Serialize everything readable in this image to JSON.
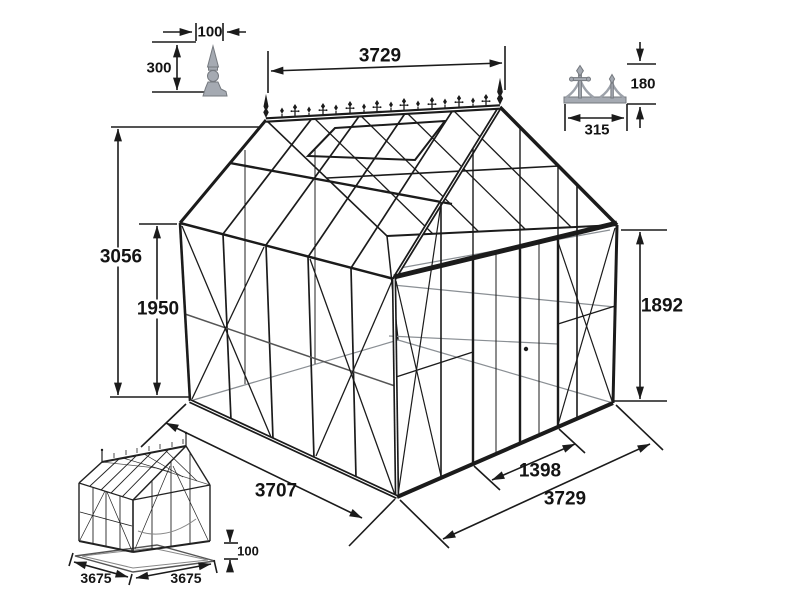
{
  "drawing": {
    "background": "#ffffff",
    "line_color": "#1b1b1b",
    "ornament_color": "#a5aab2"
  },
  "main_dimensions": {
    "ridge_width": "3729",
    "overall_height": "3056",
    "side_wall_height": "1950",
    "eave_height": "1892",
    "side_depth": "3707",
    "front_width": "3729",
    "door_width": "1398"
  },
  "finial_detail": {
    "width": "100",
    "height": "300"
  },
  "cresting_detail": {
    "height": "180",
    "width": "315"
  },
  "base_detail": {
    "side_depth": "3675",
    "front_width": "3675",
    "base_height": "100"
  }
}
